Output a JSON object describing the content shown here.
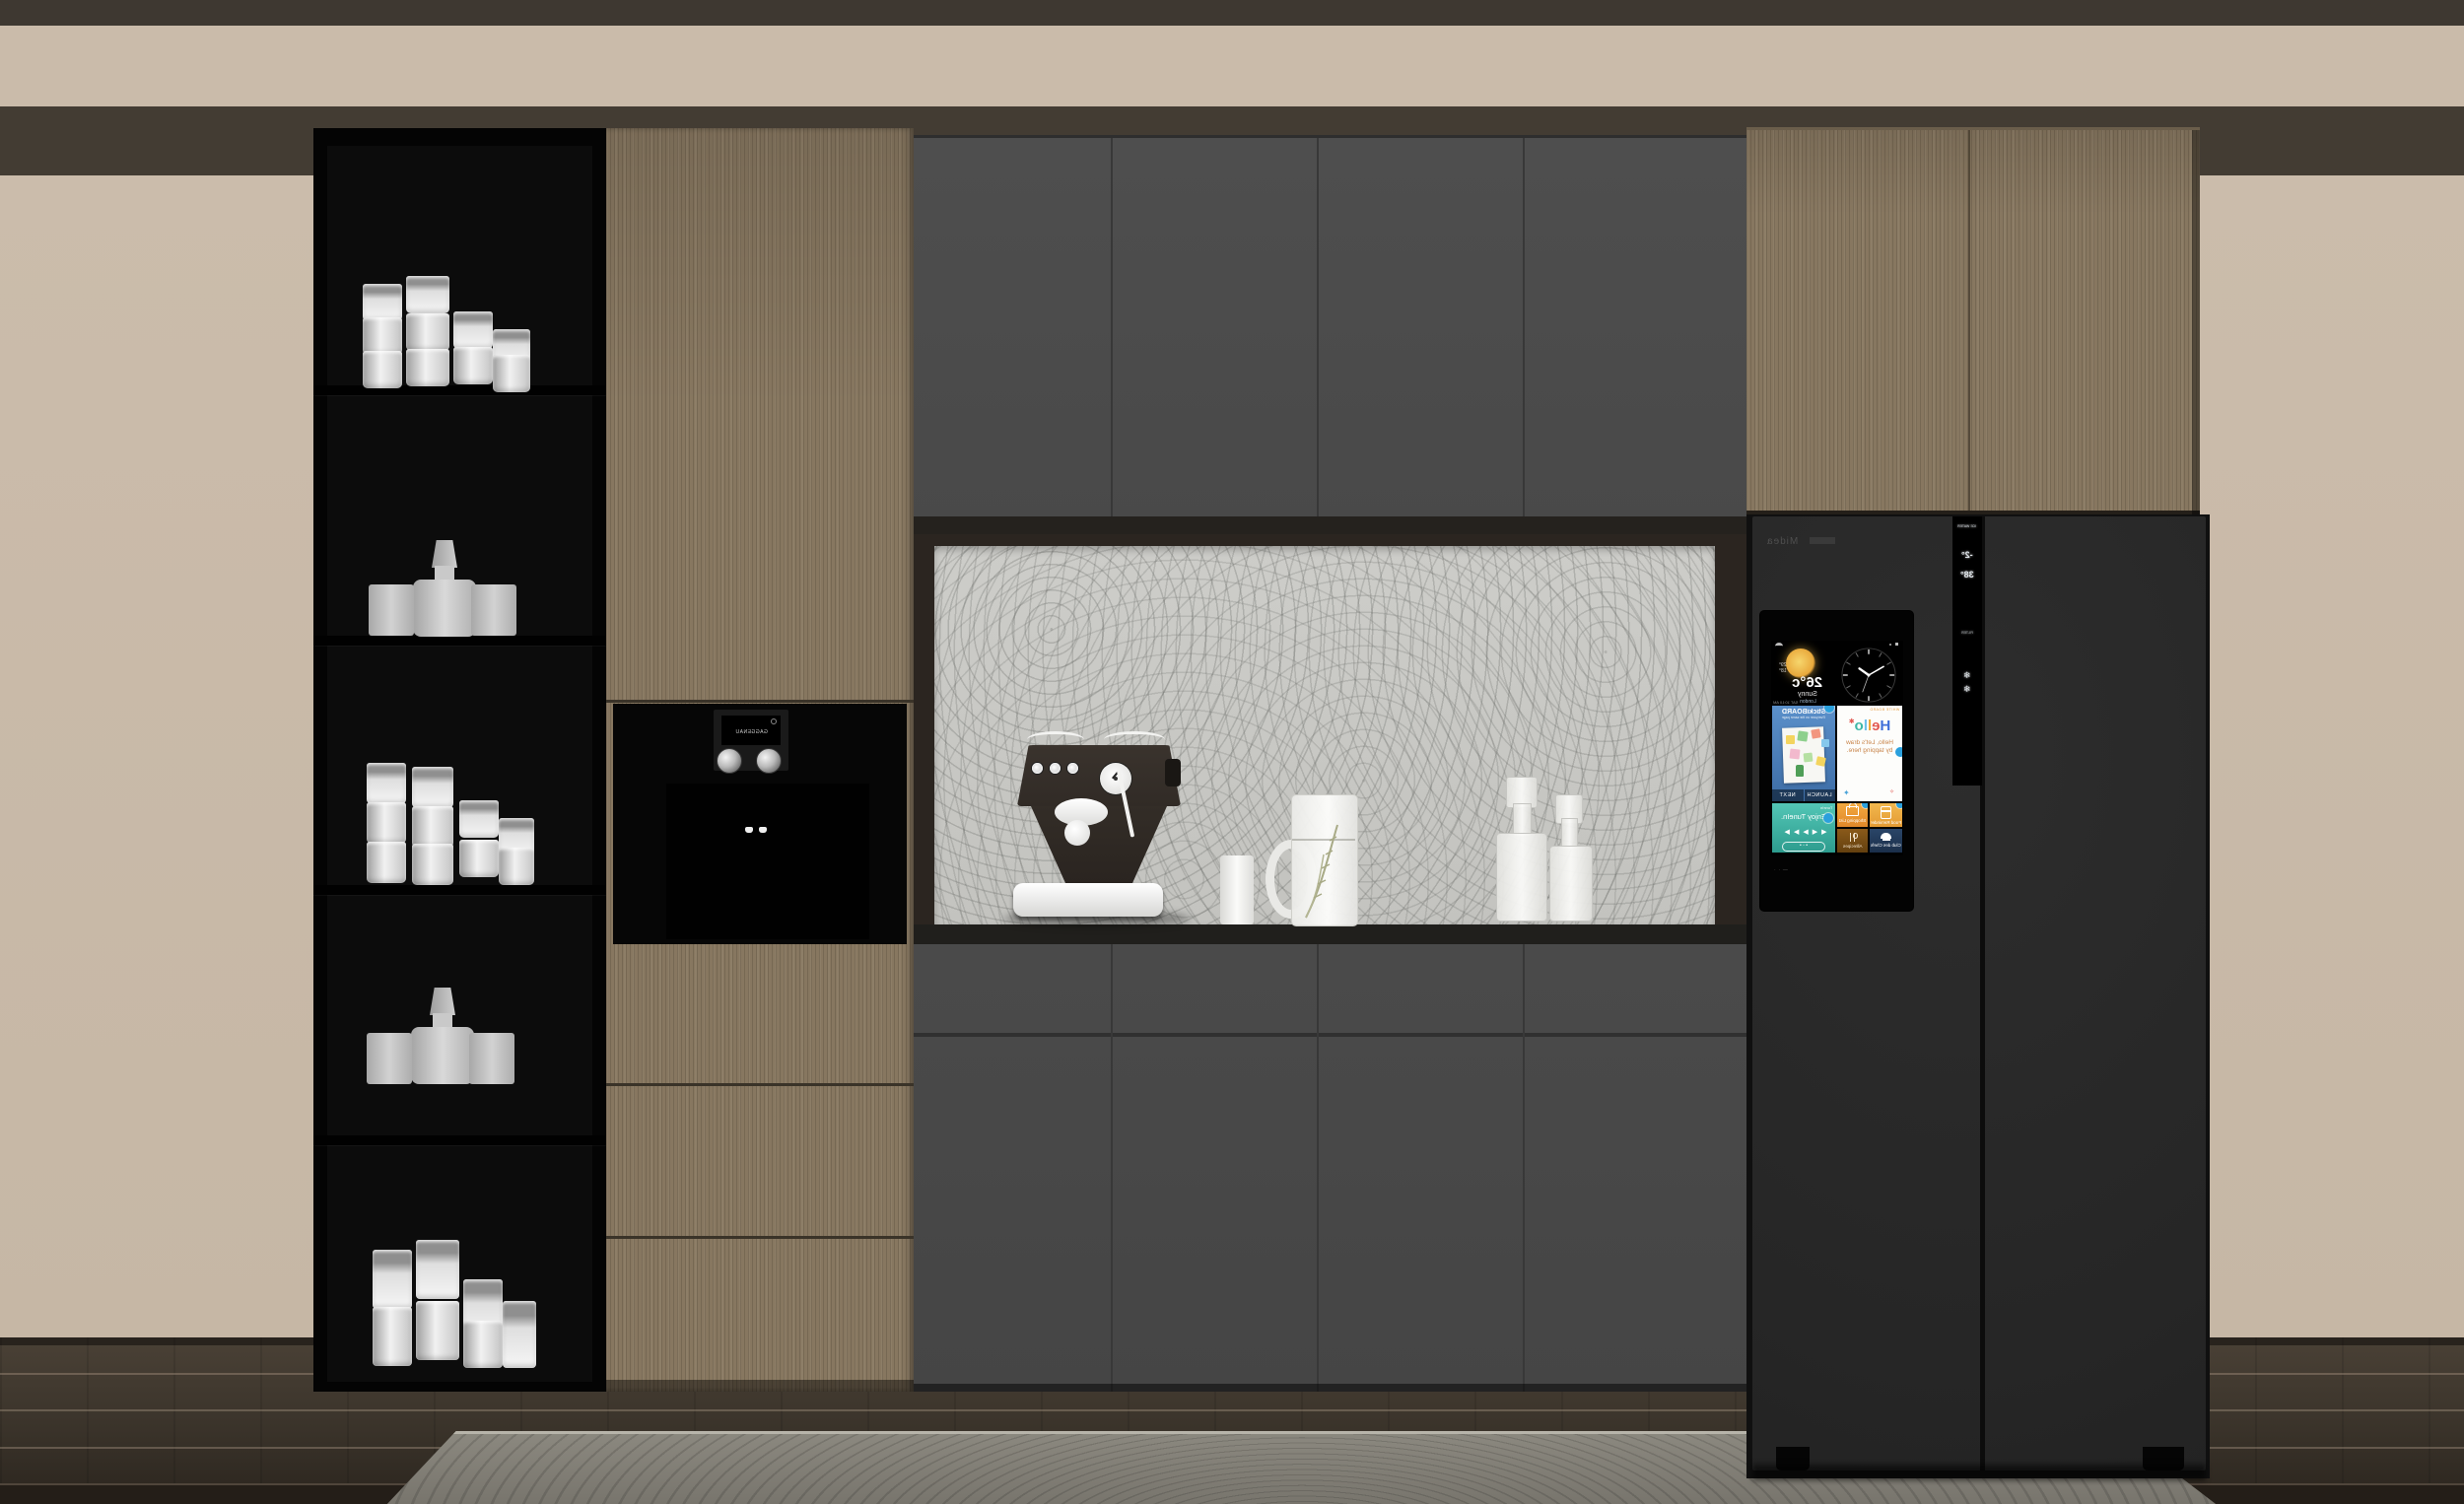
{
  "scene": {
    "description": "3D render of a kitchen cabinet wall: black open shelving with glassware, wood tall cabinet with built-in coffee machine, gray cabinets around a burl-pattern backsplash niche with an espresso machine, and a black smart refrigerator with a mirrored touchscreen.",
    "palette": {
      "wall_beige": "#cabbaa",
      "soffit_dark": "#433c33",
      "top_strip": "#3e3831",
      "wood": "#877760",
      "cabinet_gray": "#4b4b4b",
      "counter_dark": "#201f1c",
      "shelf_black": "#040404",
      "fridge_charcoal": "#282828",
      "floor_dark": "#3a332a",
      "rug_gray": "#83807a",
      "accent_badge_blue": "#2ba0dd",
      "tile_blue": "#4a7fc0",
      "tile_teal": "#3ab6a6",
      "tile_orange": "#eda03a",
      "tile_amber": "#7a4a12",
      "tile_navy": "#22375a"
    }
  },
  "shelving": {
    "shelf_count": 5,
    "shelves": [
      {
        "contents": "stacked white cups"
      },
      {
        "contents": "glass decanter with stopper and two tumblers"
      },
      {
        "contents": "stacked white cups"
      },
      {
        "contents": "glass decanter with stopper and two tumblers"
      },
      {
        "contents": "tall frosted tumblers"
      }
    ]
  },
  "coffee_machine": {
    "display_text": "GAGGENAU"
  },
  "fridge": {
    "brand_text": "Midea",
    "screen": {
      "weather": {
        "temp": "26°c",
        "high": "29°",
        "low": "18°",
        "condition": "Sunny",
        "location": "London",
        "datetime": "SAT 10:10 AM"
      },
      "clock_time": "10:10",
      "tiles": {
        "sticki": {
          "title": "StickiBOARD",
          "subtitle": "Everyone on the same page",
          "next_label": "NEXT",
          "launch_label": "LAUNCH"
        },
        "hello": {
          "caption": "WHITE BOARD",
          "letters": [
            "H",
            "e",
            "l",
            "l",
            "o"
          ],
          "subtitle": "Hello, Let's draw by tapping here."
        },
        "tunein": {
          "caption": "TuneIn",
          "title": "Enjoy TuneIn.",
          "controls": [
            "◀◀",
            "▶",
            "▶▶"
          ]
        },
        "shopping": {
          "label": "Shopping List"
        },
        "food": {
          "label": "Food Reminder"
        },
        "recipes": {
          "label": "Allrecipes"
        },
        "club": {
          "label": "Club des Chefs"
        }
      }
    },
    "dispenser": {
      "top_label": "ICE WATER",
      "freezer_temp": "-2°",
      "fridge_temp": "38°",
      "filter_label": "FILTER",
      "ice_icon": "❄"
    }
  }
}
